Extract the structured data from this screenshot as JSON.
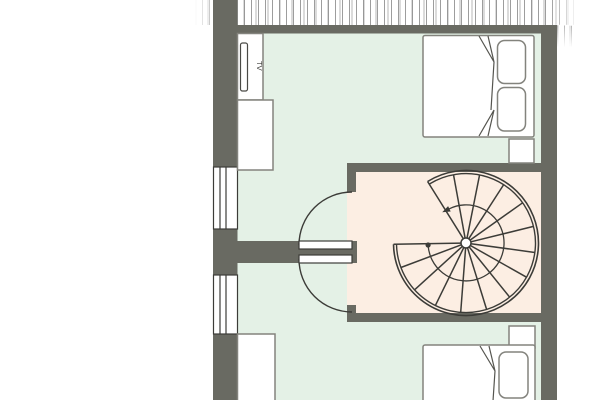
{
  "labels": {
    "tv": "TV"
  },
  "colors": {
    "floor_bedroom": "#e4f1e6",
    "floor_stair": "#fceee3",
    "wall": "#696a62",
    "line": "#3c3c38",
    "furniture_border": "#83837d",
    "white": "#ffffff"
  },
  "floorplan": {
    "type": "floor-plan",
    "rooms": [
      {
        "id": "bedroom-top",
        "floor": "mint-green",
        "furniture": [
          "tv-cabinet",
          "tv",
          "wardrobe",
          "double-bed",
          "pillow",
          "pillow",
          "nightstand"
        ],
        "windows": 1
      },
      {
        "id": "stair-room",
        "floor": "peach",
        "furniture": [
          "spiral-staircase"
        ],
        "doors": 2
      },
      {
        "id": "bedroom-bottom",
        "floor": "mint-green",
        "furniture": [
          "cabinet",
          "double-bed",
          "pillow",
          "nightstand"
        ],
        "windows": 1
      }
    ],
    "stair": {
      "type": "spiral",
      "treads": 14,
      "walk_direction": "counter-clockwise"
    }
  }
}
